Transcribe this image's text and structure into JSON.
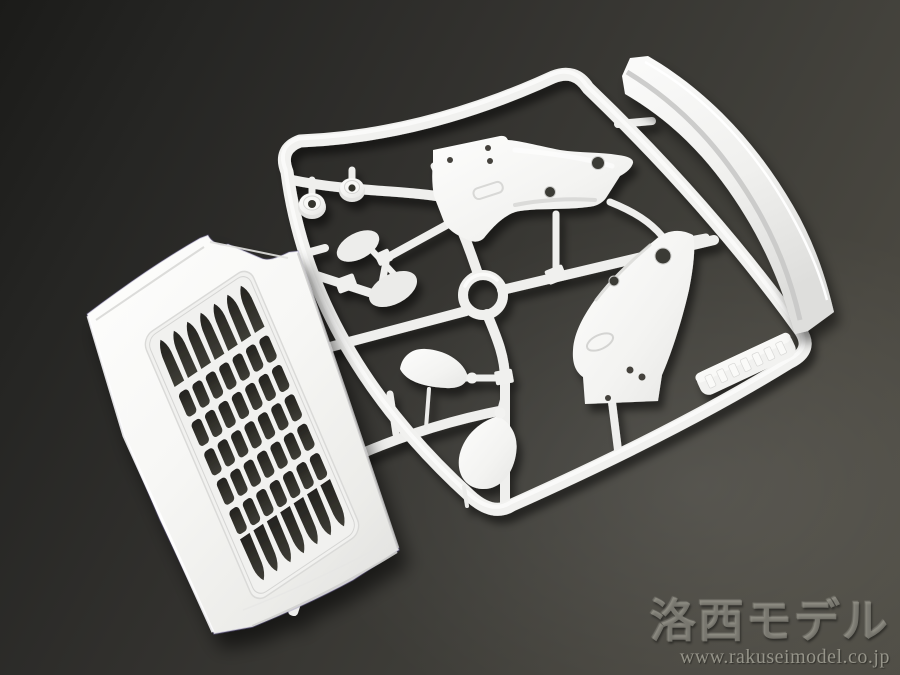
{
  "scene": {
    "description": "Photograph of a white injection-molded plastic model sprue (runner) with truck body parts on a dark gray studio background",
    "background_colors": {
      "top_left": "#1b1b19",
      "center": "#38372f",
      "bottom_right": "#4e4c44"
    },
    "plastic_color": "#f2f2f0"
  },
  "watermark": {
    "brand": "洛西モデル",
    "url": "www.rakuseimodel.co.jp"
  },
  "parts": {
    "grille_panel": {
      "label": "cab front grille panel",
      "slot_columns": 7,
      "slot_rows": 7
    },
    "runner_frame": {
      "label": "rounded rectangular sprue runner frame"
    },
    "round_caps": {
      "label": "round cap bushings",
      "count": 2
    },
    "mirror_faces": {
      "label": "teardrop mirror faces",
      "count": 2
    },
    "mirror_housings": {
      "label": "side mirror housings",
      "count": 2
    },
    "bracket_pieces": {
      "label": "fender bracket pieces with holes",
      "count": 2
    },
    "ring_part": {
      "label": "circular ring part",
      "count": 1
    },
    "side_deflector": {
      "label": "long curved wind deflector blade",
      "count": 1
    },
    "molded_tab": {
      "label": "embossed molded brand tab (text illegible)"
    }
  }
}
